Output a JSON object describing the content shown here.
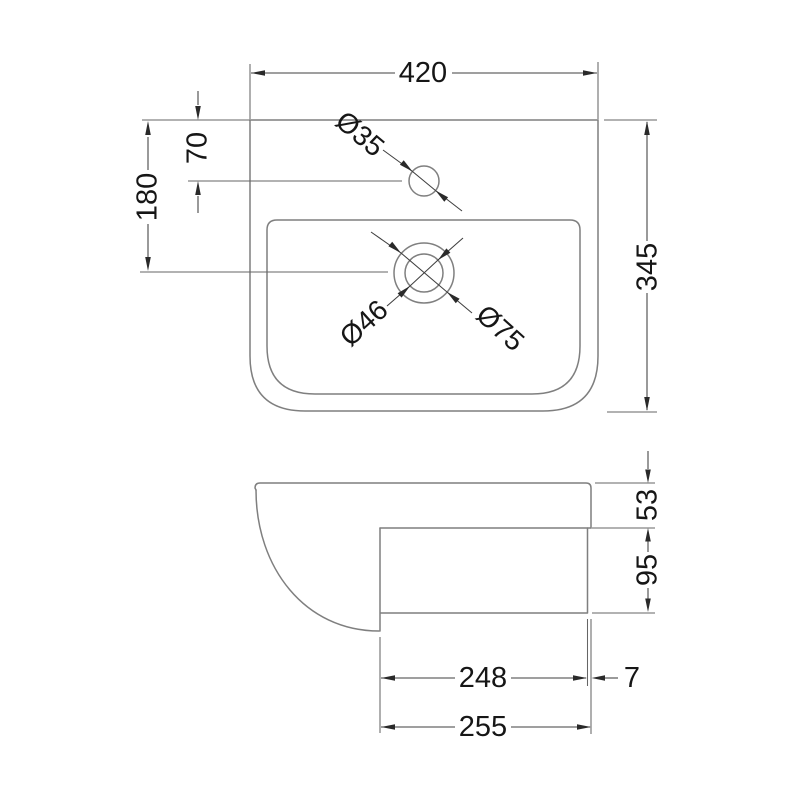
{
  "drawing": {
    "kind": "technical-dimension-drawing",
    "subject": "basin-two-view-drawing",
    "colors": {
      "background": "#ffffff",
      "outline": "#7f7f7f",
      "dimension_lines": "#3f3f3f",
      "text": "#161616"
    },
    "top_view": {
      "overall_width": "420",
      "overall_depth": "345",
      "tap_hole_offset": "70",
      "waste_centre_offset": "180",
      "tap_hole_diameter": "Ø35",
      "waste_inner_diameter": "Ø46",
      "waste_outer_diameter": "Ø75"
    },
    "side_view": {
      "rim_height": "53",
      "body_height": "95",
      "body_depth": "248",
      "rim_overhang": "7",
      "overall_depth": "255"
    }
  }
}
